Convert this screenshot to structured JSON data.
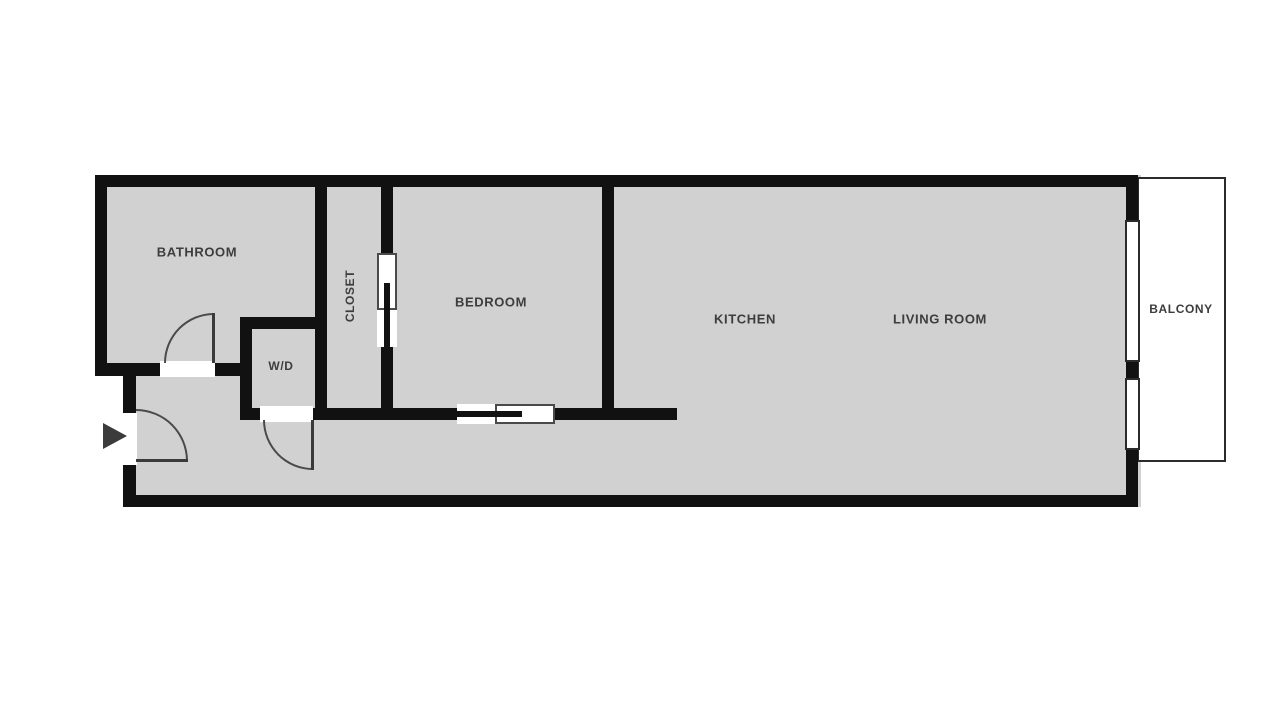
{
  "floorplan": {
    "title": "one-bedroom apartment floor plan",
    "rooms": [
      {
        "id": "bathroom",
        "label": "BATHROOM"
      },
      {
        "id": "closet",
        "label": "CLOSET"
      },
      {
        "id": "wd",
        "label": "W/D"
      },
      {
        "id": "bedroom",
        "label": "BEDROOM"
      },
      {
        "id": "kitchen",
        "label": "KITCHEN"
      },
      {
        "id": "living-room",
        "label": "LIVING ROOM"
      },
      {
        "id": "balcony",
        "label": "BALCONY"
      }
    ],
    "icons": [
      {
        "name": "entry-arrow-icon",
        "meaning": "unit entry direction"
      }
    ],
    "colors": {
      "floor": "#d1d1d1",
      "wall": "#111111",
      "door_swing": "#4a4a4a",
      "label_text": "#3d3d3d",
      "outside": "#ffffff",
      "entry_arrow": "#3b3b3b"
    }
  }
}
